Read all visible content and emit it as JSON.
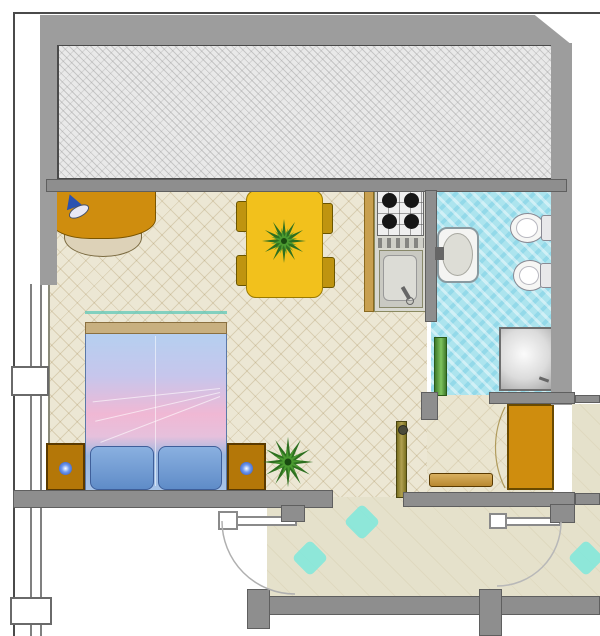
{
  "meta": {
    "title": "Studio apartment floor plan",
    "kind": "architectural floor plan, top-down colour rendering",
    "visible_text": "none"
  },
  "palette": {
    "wall_gray": "#9d9d9d",
    "wall_outline": "#5f5f5f",
    "terrace_hatch": "#e9e9e9",
    "room_floor": "#ece7d4",
    "entry_floor": "#eae5d0",
    "bathroom_floor": "#ace4ee",
    "corridor_floor": "#e5e1cb",
    "furniture_orange": "#cf8d0e",
    "table_yellow": "#f2c11c",
    "chair_olive": "#bf9410",
    "plant_green": "#2e7020",
    "accent_cyan": "#7fe8dc",
    "bed_blue": "#9ec2ea",
    "bed_pink": "#f0bcd8"
  },
  "rooms": [
    {
      "name": "terrace",
      "description": "hatched balcony strip along the top, wrapped by thick gray walls"
    },
    {
      "name": "living-sleeping-room",
      "description": "main room with cream diamond-tile floor",
      "furniture": [
        "desk with blue lamp",
        "desk chair",
        "dining table with plant centerpiece",
        "four dining chairs",
        "double bed with blue-pink duvet and two pillows",
        "two nightstands with glowing lamps",
        "potted plant"
      ]
    },
    {
      "name": "kitchenette",
      "furniture": [
        "four-burner stove",
        "control strip",
        "sink with faucet"
      ]
    },
    {
      "name": "bathroom",
      "description": "cyan tiled floor",
      "furniture": [
        "washbasin",
        "toilet",
        "bidet",
        "corner shower",
        "green door leaf"
      ]
    },
    {
      "name": "entry-hall",
      "furniture": [
        "wardrobe",
        "shoe bench",
        "open entry door"
      ]
    },
    {
      "name": "corridor",
      "description": "shared landing with cyan diamond tile accents and a door swing arc"
    },
    {
      "name": "adjacent-unit",
      "description": "white space at lower left with its own door leaf and swing arc"
    }
  ]
}
